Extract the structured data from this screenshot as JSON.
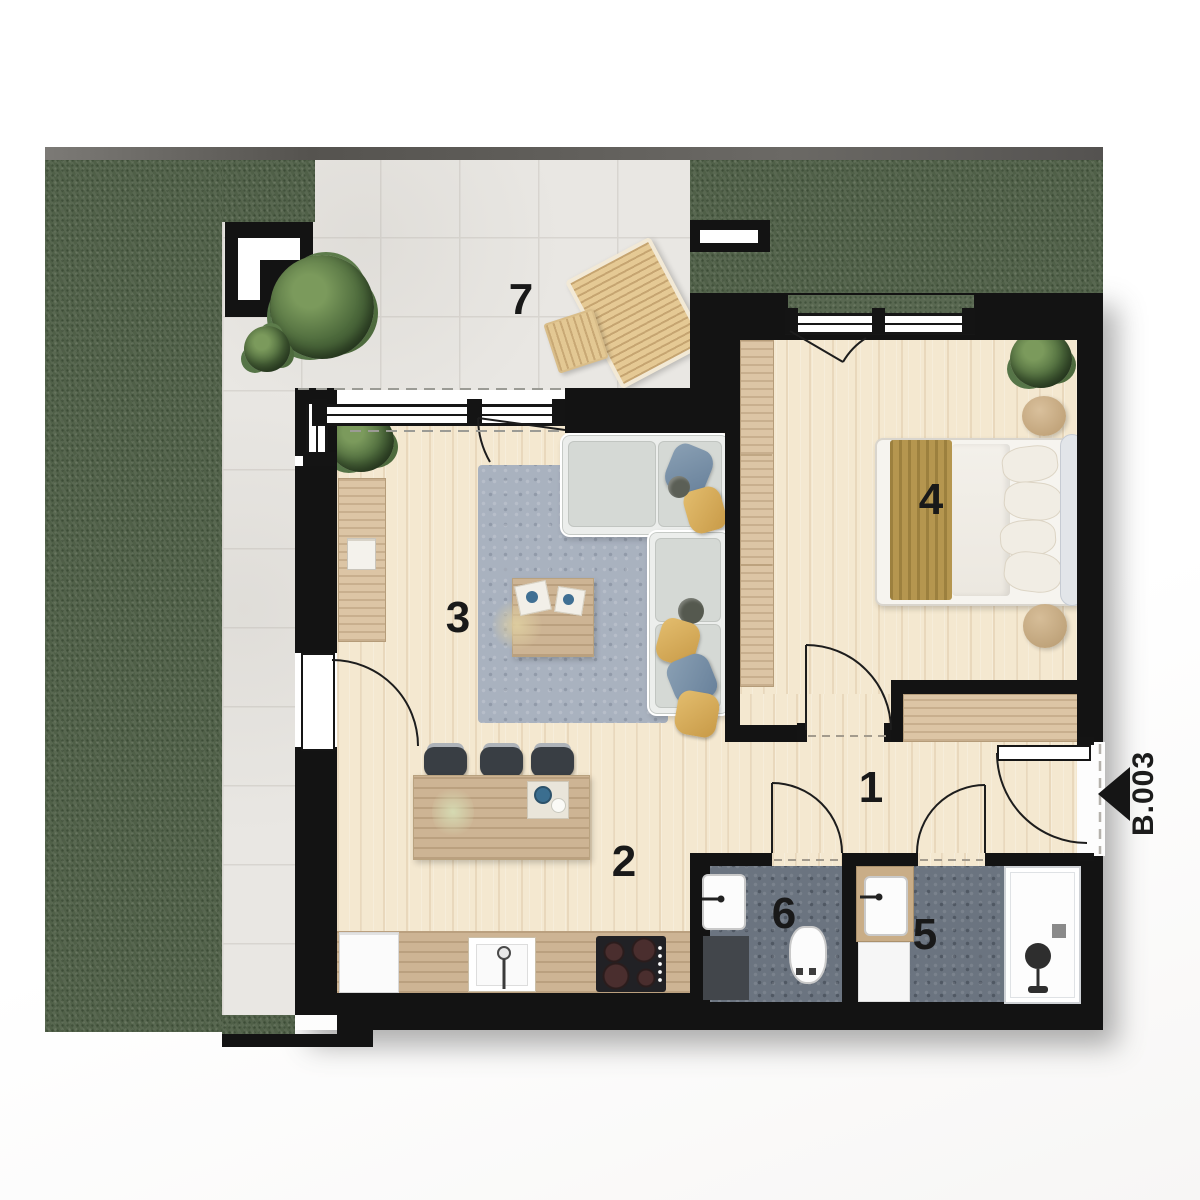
{
  "unit": {
    "label": "B.003",
    "entrance_arrow_direction": "left"
  },
  "rooms": {
    "hallway": {
      "label": "1"
    },
    "kitchen_dining": {
      "label": "2"
    },
    "living_room": {
      "label": "3"
    },
    "bedroom": {
      "label": "4"
    },
    "bathroom": {
      "label": "5"
    },
    "wc": {
      "label": "6"
    },
    "terrace": {
      "label": "7"
    }
  },
  "colors": {
    "wall": "#131313",
    "grass": "#596851",
    "terrace_tile": "#e9e7e3",
    "wood_floor": "#f4e8d0",
    "counter_wood": "#cdb494",
    "bathroom_floor": "#6b7480",
    "rug": "#a9b2bf",
    "accent_gold": "#b5964f",
    "accent_blue": "#7d8fa6"
  }
}
